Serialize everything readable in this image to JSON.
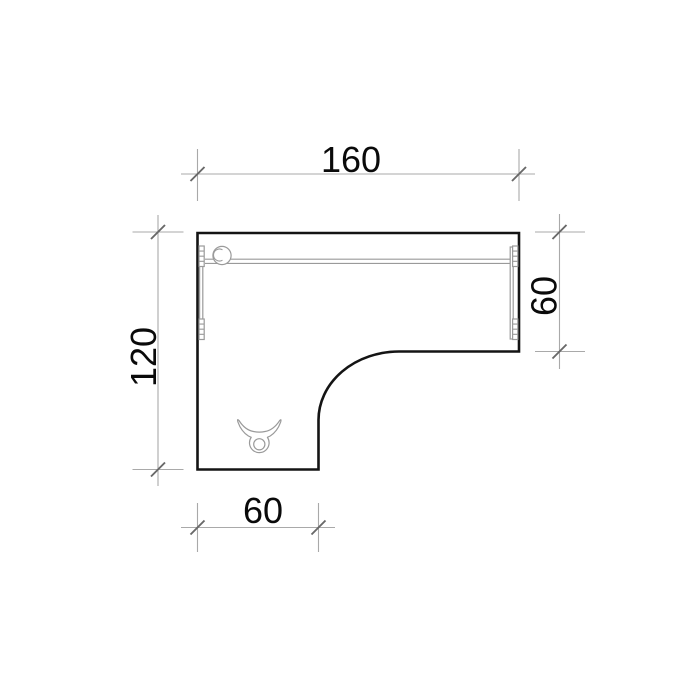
{
  "drawing": {
    "shape": "l-shaped-desk-top-view",
    "background": "#ffffff",
    "style": {
      "outline_color": "#141414",
      "detail_color": "#9a9a9a",
      "dimension_line_color": "#a9a9a9",
      "tick_color": "#686868",
      "label_color": "#0a0a0a"
    },
    "dimensions": {
      "top": {
        "label": "160",
        "value": 160,
        "orientation": "horizontal",
        "measures": "overall-width"
      },
      "left": {
        "label": "120",
        "value": 120,
        "orientation": "vertical",
        "measures": "overall-depth"
      },
      "right": {
        "label": "60",
        "value": 60,
        "orientation": "vertical",
        "measures": "right-wing-depth"
      },
      "bottom": {
        "label": "60",
        "value": 60,
        "orientation": "horizontal",
        "measures": "left-wing-width"
      }
    },
    "symbols": {
      "grommet": "cable-grommet-icon",
      "tray": "cable-tray-icon",
      "bracket_left": "mounting-bracket-left-icon",
      "bracket_right": "mounting-bracket-right-icon",
      "leg": "desk-leg-icon"
    }
  }
}
